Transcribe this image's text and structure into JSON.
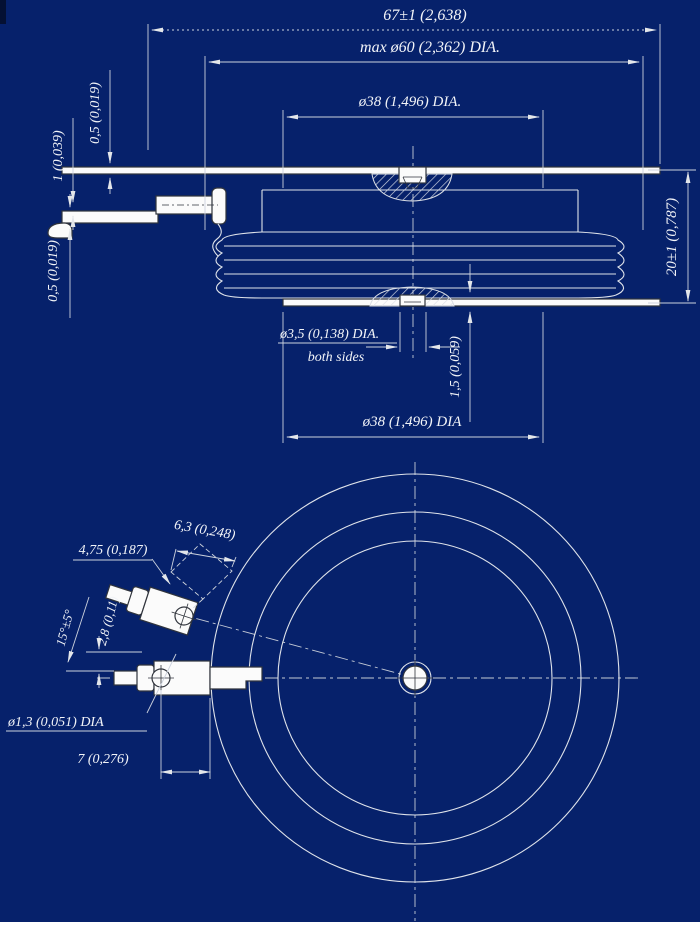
{
  "colors": {
    "background": "#06216b",
    "drawing_lines": "#dfe3ea",
    "dimension_text": "#f2f4f8",
    "page_strip": "#ffffff"
  },
  "side_view": {
    "dim_total_width": "67±1 (2,638)",
    "dim_max_outer_dia": "max ø60 (2,362) DIA.",
    "dim_pole_dia_top": "ø38 (1,496) DIA.",
    "dim_top_lead_thickness": "0,5 (0,019)",
    "dim_lead_spacing": "1 (0,039)",
    "dim_bottom_lead_thickness": "0,5 (0,019)",
    "dim_height": "20±1 (0,787)",
    "dim_center_hole_dia": "ø3,5 (0,138) DIA.",
    "center_hole_note": "both sides",
    "dim_recess_depth": "1,5 (0,059)",
    "dim_pole_dia_bottom": "ø38 (1,496) DIA"
  },
  "bottom_view": {
    "dim_terminal_width": "4,75 (0,187)",
    "dim_terminal_length": "6,3 (0,248)",
    "dim_terminal_angle": "15°±5°",
    "dim_terminal_offset": "2,8 (0,11)",
    "dim_terminal_hole_dia": "ø1,3 (0,051) DIA",
    "dim_hole_offset": "7 (0,276)"
  }
}
